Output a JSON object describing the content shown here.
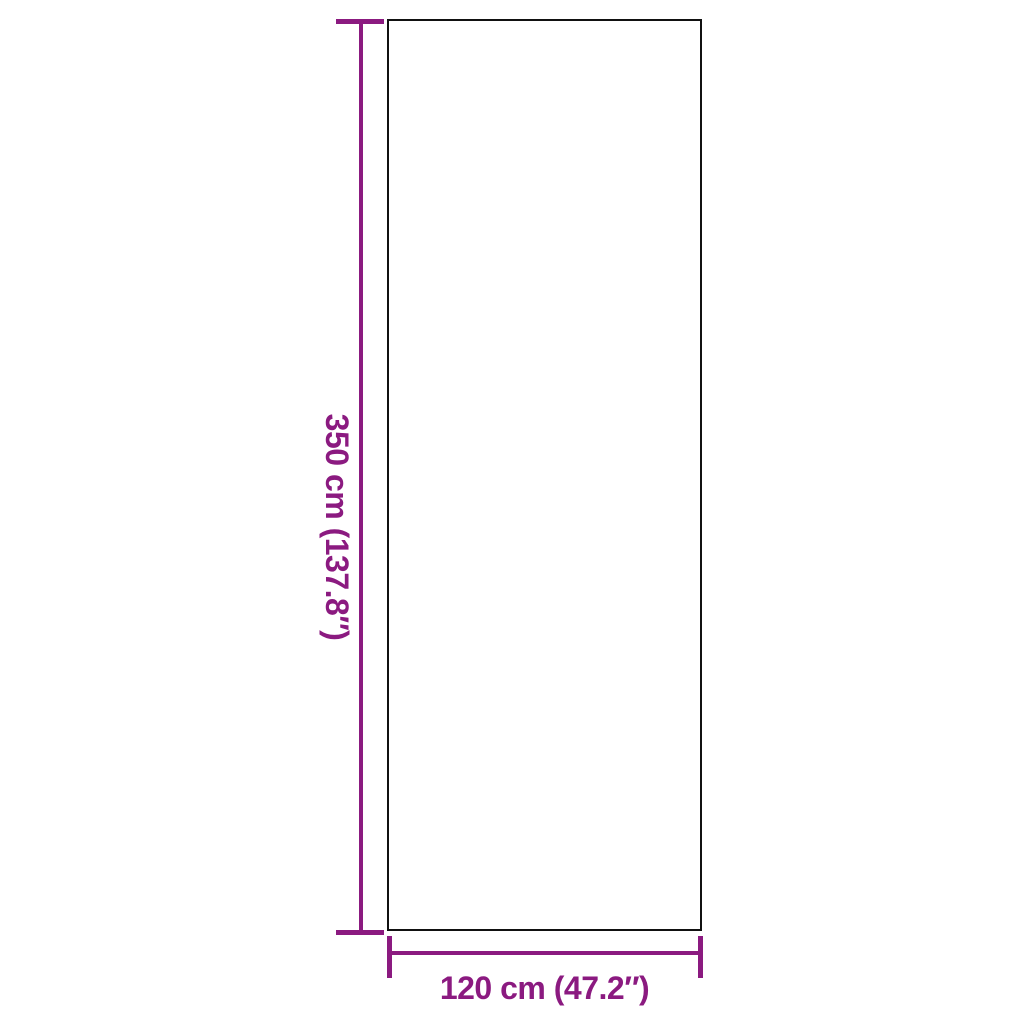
{
  "diagram": {
    "type": "product-dimension-diagram",
    "background_color": "#FFFFFF",
    "outline_color": "#111111",
    "accent_color": "#8B1A80",
    "height_label": "350 cm (137.8″)",
    "width_label": "120 cm (47.2″)"
  }
}
